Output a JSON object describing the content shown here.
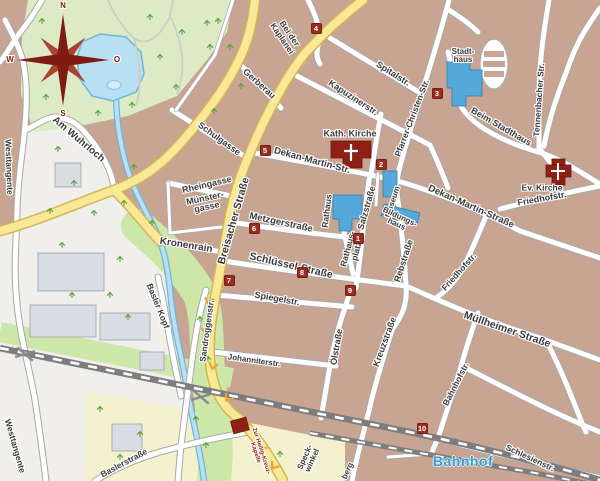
{
  "map_title": "Stadtplan Innenstadt",
  "palette": {
    "urban": "#c8a493",
    "park": "#dcebc5",
    "field": "#f4f1cf",
    "greenway": "#cde7a9",
    "meadow": "#f0efeb",
    "water": "#b9e0f2",
    "water_border": "#6fb5d9",
    "road_white": "#ffffff",
    "road_casing": "#a9a9a9",
    "main_road": "#f8e897",
    "main_road_casing": "#d4b552",
    "railway": "#7d7d7d",
    "building_public": "#54a8da",
    "building_gray": "#d9dce2",
    "poi_red": "#8e2016",
    "marker_bg": "#9b2d1f",
    "label_color": "#3a3a3a",
    "station_blue": "#2f9fd6",
    "compass_red": "#7d1b12",
    "tree_green": "#57a33b",
    "chevron_orange": "#eea437"
  },
  "compass": {
    "north": "N",
    "east": "O",
    "south": "S",
    "west": "W"
  },
  "markers": [
    {
      "number": "1",
      "x": 358,
      "y": 238
    },
    {
      "number": "2",
      "x": 381,
      "y": 164
    },
    {
      "number": "3",
      "x": 437,
      "y": 93
    },
    {
      "number": "4",
      "x": 316,
      "y": 28
    },
    {
      "number": "5",
      "x": 265,
      "y": 150
    },
    {
      "number": "6",
      "x": 254,
      "y": 228
    },
    {
      "number": "7",
      "x": 229,
      "y": 280
    },
    {
      "number": "8",
      "x": 302,
      "y": 272
    },
    {
      "number": "9",
      "x": 350,
      "y": 290
    },
    {
      "number": "10",
      "x": 422,
      "y": 428
    }
  ],
  "labels": [
    {
      "name": "street-label-am-wuhrloch",
      "text": "Am Wuhrloch",
      "x": 78,
      "y": 140,
      "rot": 40,
      "size": 10,
      "kind": "street"
    },
    {
      "name": "street-label-westtangente-north",
      "text": "Westtangente",
      "x": 9,
      "y": 167,
      "rot": 88,
      "size": 8.5,
      "kind": "street"
    },
    {
      "name": "street-label-westtangente-south",
      "text": "Westtangente",
      "x": 15,
      "y": 446,
      "rot": 74,
      "size": 8.5,
      "kind": "street"
    },
    {
      "name": "street-label-schulgasse",
      "text": "Schulgasse",
      "x": 219,
      "y": 139,
      "rot": 36,
      "size": 9,
      "kind": "street"
    },
    {
      "name": "street-label-gerberau",
      "text": "Gerberau",
      "x": 259,
      "y": 84,
      "rot": 42,
      "size": 9,
      "kind": "street"
    },
    {
      "name": "street-label-bei-der-kaplanei",
      "text": "Bei der\nKaplanei",
      "x": 286,
      "y": 36,
      "rot": 56,
      "size": 8.5,
      "kind": "street"
    },
    {
      "name": "street-label-kapuzinerstr",
      "text": "Kapuzinerstr.",
      "x": 353,
      "y": 98,
      "rot": 33,
      "size": 9,
      "kind": "street"
    },
    {
      "name": "street-label-spitalstr",
      "text": "Spitalstr.",
      "x": 393,
      "y": 74,
      "rot": 32,
      "size": 9,
      "kind": "street"
    },
    {
      "name": "street-label-pfarrer-christen-str",
      "text": "Pfarrer-Christen-Str.",
      "x": 412,
      "y": 118,
      "rot": -69,
      "size": 8.5,
      "kind": "street"
    },
    {
      "name": "street-label-dekan-martin-str",
      "text": "Dekan-Martin-Str.",
      "x": 312,
      "y": 161,
      "rot": 15,
      "size": 9.5,
      "kind": "street"
    },
    {
      "name": "street-label-dekan-martin-strasse",
      "text": "Dekan-Martin-Straße",
      "x": 471,
      "y": 207,
      "rot": 24,
      "size": 9.5,
      "kind": "street"
    },
    {
      "name": "street-label-salzstrasse",
      "text": "Salzstraße",
      "x": 367,
      "y": 208,
      "rot": -74,
      "size": 9,
      "kind": "street"
    },
    {
      "name": "street-label-metzgerstrasse",
      "text": "Metzgerstraße",
      "x": 281,
      "y": 223,
      "rot": 12,
      "size": 9.5,
      "kind": "street"
    },
    {
      "name": "street-label-rebstrasse",
      "text": "Rebstraße",
      "x": 404,
      "y": 261,
      "rot": -72,
      "size": 9,
      "kind": "street"
    },
    {
      "name": "street-label-schluessel-strasse",
      "text": "Schlüssel-Straße",
      "x": 291,
      "y": 266,
      "rot": 13,
      "size": 10.5,
      "kind": "street"
    },
    {
      "name": "street-label-spiegelstr",
      "text": "Spiegelstr.",
      "x": 277,
      "y": 299,
      "rot": 10,
      "size": 9,
      "kind": "street"
    },
    {
      "name": "street-label-johanniterstr",
      "text": "Johanniterstr.",
      "x": 254,
      "y": 361,
      "rot": 8,
      "size": 8,
      "kind": "street"
    },
    {
      "name": "street-label-oelstrasse",
      "text": "Ölstraße",
      "x": 337,
      "y": 347,
      "rot": -80,
      "size": 9,
      "kind": "street"
    },
    {
      "name": "street-label-kreuzstrasse",
      "text": "Kreuzstraße",
      "x": 385,
      "y": 342,
      "rot": -70,
      "size": 9,
      "kind": "street"
    },
    {
      "name": "street-label-sandroggenstr",
      "text": "Sandroggenstr.",
      "x": 207,
      "y": 331,
      "rot": -82,
      "size": 8.5,
      "kind": "street"
    },
    {
      "name": "street-label-basler-kopf",
      "text": "Basler Kopf",
      "x": 158,
      "y": 306,
      "rot": 68,
      "size": 8.5,
      "kind": "street"
    },
    {
      "name": "street-label-kronenrain",
      "text": "Kronenrain",
      "x": 186,
      "y": 246,
      "rot": 9,
      "size": 10,
      "kind": "street"
    },
    {
      "name": "street-label-breisacher-strasse",
      "text": "Breisacher Straße",
      "x": 234,
      "y": 221,
      "rot": -74,
      "size": 10.5,
      "kind": "street"
    },
    {
      "name": "street-label-muellheimer-strasse",
      "text": "Müllheimer Straße",
      "x": 507,
      "y": 330,
      "rot": 19,
      "size": 10.5,
      "kind": "street"
    },
    {
      "name": "street-label-bahnhofstr",
      "text": "Bahnhofstr.",
      "x": 456,
      "y": 384,
      "rot": -63,
      "size": 8.5,
      "kind": "street"
    },
    {
      "name": "street-label-schlesienstr",
      "text": "Schlesienstr.",
      "x": 530,
      "y": 458,
      "rot": 25,
      "size": 8.5,
      "kind": "street"
    },
    {
      "name": "street-label-friedhofstr-sued",
      "text": "Friedhofstr.",
      "x": 459,
      "y": 272,
      "rot": -48,
      "size": 8.5,
      "kind": "street"
    },
    {
      "name": "street-label-friedhofstr-ost",
      "text": "Friedhofstr.",
      "x": 542,
      "y": 199,
      "rot": -10,
      "size": 9,
      "kind": "street"
    },
    {
      "name": "street-label-beim-stadthaus",
      "text": "Beim Stadthaus",
      "x": 501,
      "y": 127,
      "rot": 30,
      "size": 9,
      "kind": "street"
    },
    {
      "name": "street-label-tennenbacher-str",
      "text": "Tennenbacher Str.",
      "x": 539,
      "y": 100,
      "rot": -86,
      "size": 8.5,
      "kind": "street"
    },
    {
      "name": "street-label-rheingasse",
      "text": "Rheingasse",
      "x": 207,
      "y": 185,
      "rot": -13,
      "size": 9,
      "kind": "street"
    },
    {
      "name": "street-label-muenstergasse",
      "text": "Münster-\ngasse",
      "x": 206,
      "y": 203,
      "rot": -12,
      "size": 9,
      "kind": "street"
    },
    {
      "name": "street-label-baslerstrasse",
      "text": "Baslerstraße",
      "x": 124,
      "y": 463,
      "rot": -28,
      "size": 8.5,
      "kind": "street"
    },
    {
      "name": "street-label-speckwinkel",
      "text": "Speck-\nwinkel",
      "x": 309,
      "y": 459,
      "rot": -66,
      "size": 8,
      "kind": "street"
    },
    {
      "name": "street-label-berg-fragment",
      "text": "berg",
      "x": 348,
      "y": 471,
      "rot": -66,
      "size": 8,
      "kind": "street"
    },
    {
      "name": "poi-label-kath-kirche",
      "text": "Kath. Kirche",
      "x": 350,
      "y": 134,
      "rot": 0,
      "size": 9,
      "kind": "poi"
    },
    {
      "name": "poi-label-ev-kirche",
      "text": "Ev. Kirche",
      "x": 542,
      "y": 188,
      "rot": 0,
      "size": 8.5,
      "kind": "poi"
    },
    {
      "name": "poi-label-stadthaus",
      "text": "Stadt-\nhaus",
      "x": 463,
      "y": 56,
      "rot": 0,
      "size": 8,
      "kind": "poi"
    },
    {
      "name": "poi-label-rathaus",
      "text": "Rathaus",
      "x": 327,
      "y": 211,
      "rot": -83,
      "size": 8.5,
      "kind": "poi"
    },
    {
      "name": "poi-label-rathausplatz",
      "text": "Rathaus-\nplatz",
      "x": 352,
      "y": 250,
      "rot": -75,
      "size": 8.5,
      "kind": "poi"
    },
    {
      "name": "poi-label-museum",
      "text": "Museum",
      "x": 393,
      "y": 202,
      "rot": -72,
      "size": 8,
      "kind": "poi"
    },
    {
      "name": "poi-label-bildungshaus",
      "text": "Bildungs-\nhaus",
      "x": 398,
      "y": 221,
      "rot": 25,
      "size": 8,
      "kind": "poi"
    },
    {
      "name": "poi-label-heilig-kreuz-kapelle",
      "text": "Zur Heilig-Kreuz-\nKapelle",
      "x": 258,
      "y": 452,
      "rot": 72,
      "size": 6,
      "kind": "poi-red"
    },
    {
      "name": "station-label-bahnhof",
      "text": "Bahnhof",
      "x": 463,
      "y": 461,
      "rot": 0,
      "size": 14,
      "kind": "station"
    },
    {
      "name": "compass-letter-n",
      "text": "N",
      "x": 63,
      "y": 6,
      "rot": 0,
      "size": 8,
      "kind": "compass"
    },
    {
      "name": "compass-letter-o",
      "text": "O",
      "x": 117,
      "y": 60,
      "rot": 0,
      "size": 8,
      "kind": "compass"
    },
    {
      "name": "compass-letter-s",
      "text": "S",
      "x": 63,
      "y": 114,
      "rot": 0,
      "size": 8,
      "kind": "compass"
    },
    {
      "name": "compass-letter-w",
      "text": "W",
      "x": 10,
      "y": 60,
      "rot": 0,
      "size": 8,
      "kind": "compass"
    }
  ]
}
